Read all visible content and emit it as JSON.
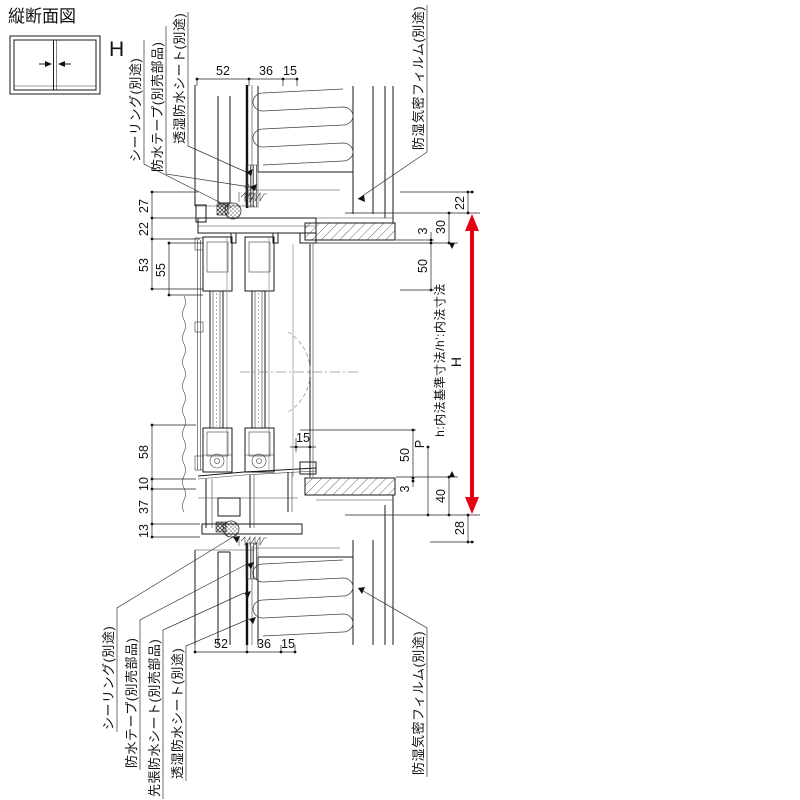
{
  "title": "縦断面図",
  "window_icon": {
    "label": "H"
  },
  "callouts": {
    "top_left": [
      "シーリング(別途)",
      "防水テープ(別売部品)",
      "透湿防水シート(別途)"
    ],
    "top_right": [
      "防湿気密フィルム(別途)"
    ],
    "bottom_left": [
      "シーリング(別途)",
      "防水テープ(別売部品)",
      "先張防水シート(別売部品)",
      "透湿防水シート(別途)"
    ],
    "bottom_right": [
      "防湿気密フィルム(別途)"
    ]
  },
  "dimensions": {
    "top": [
      "52",
      "36",
      "15"
    ],
    "bottom": [
      "52",
      "36",
      "15"
    ],
    "left_upper": [
      "27",
      "22",
      "53",
      "55"
    ],
    "left_lower": [
      "58",
      "10",
      "37",
      "13"
    ],
    "right_upper": [
      "22",
      "30",
      "3",
      "50"
    ],
    "right_lower": [
      "15",
      "50",
      "P",
      "3",
      "40",
      "28"
    ]
  },
  "height_marker": {
    "label": "H",
    "note": "h:内法基準寸法/h':内法寸法",
    "arrow_color": "#e60012"
  }
}
